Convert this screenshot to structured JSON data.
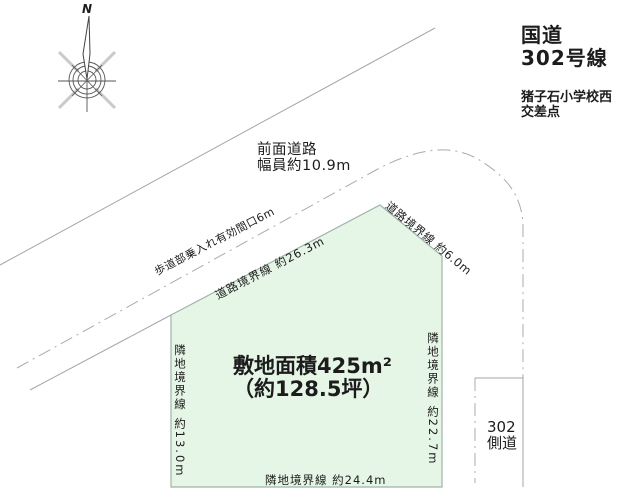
{
  "colors": {
    "plot_fill": "#e6f6e6",
    "plot_border": "#9fb3a9",
    "road_line": "#a6a6a6",
    "compass_dark": "#555555",
    "compass_light": "#c9c9c9",
    "text": "#1c1c1c"
  },
  "compass": {
    "north_label": "N"
  },
  "annotations": {
    "route": {
      "line1": "国道",
      "line2": "302号線"
    },
    "intersection": {
      "line1": "猪子石小学校西",
      "line2": "交差点"
    },
    "front_road": {
      "line1": "前面道路",
      "line2": "幅員約10.9m"
    },
    "sidewalk_entry": "歩道部乗入れ有効間口6m",
    "road_boundary_top": "道路境界線 約26.3m",
    "road_boundary_corner": "道路境界線 約6.0m",
    "neighbor_boundary_left": "隣地境界線 約13.0m",
    "neighbor_boundary_right": "隣地境界線 約22.7m",
    "neighbor_boundary_bottom": "隣地境界線 約24.4m",
    "side_road": {
      "line1": "302",
      "line2": "側道"
    }
  },
  "plot": {
    "area_line1": "敷地面積425m²",
    "area_line2": "（約128.5坪）"
  }
}
